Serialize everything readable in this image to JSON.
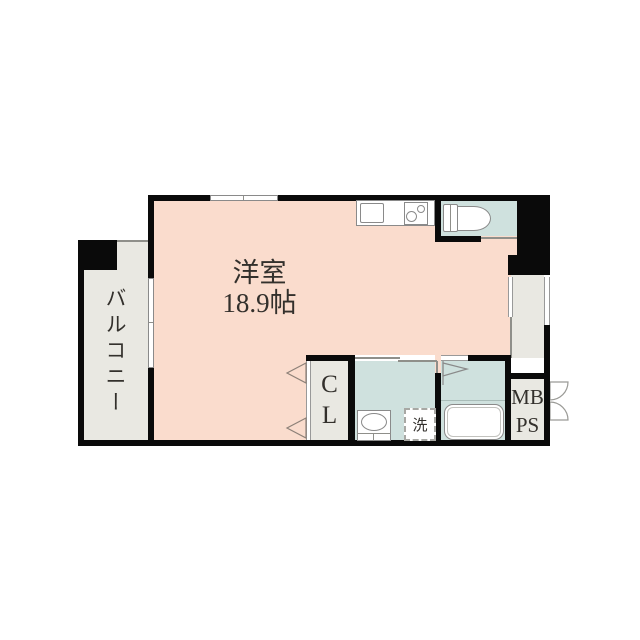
{
  "plan": {
    "type": "apartment-floor-plan",
    "rooms": {
      "main_room": {
        "name": "洋室",
        "size": "18.9帖",
        "fill": "#fadccd"
      },
      "balcony": {
        "label": "バルコニー",
        "fill": "#e9e8e2"
      },
      "closet": {
        "line1": "C",
        "line2": "L",
        "fill": "#e9e8e2"
      },
      "washroom": {
        "washer_label": "洗",
        "fill": "#cfe1de"
      },
      "bathroom": {
        "fill": "#cfe1de"
      },
      "toilet": {
        "fill": "#cfe1de"
      },
      "meter_pipe_space": {
        "line1": "MB",
        "line2": "PS",
        "fill": "#e9e8e2"
      }
    },
    "colors": {
      "wall": "#0a0a0a",
      "background": "#ffffff",
      "fixture_outline": "#8a8a8a",
      "text": "#33302c"
    }
  }
}
